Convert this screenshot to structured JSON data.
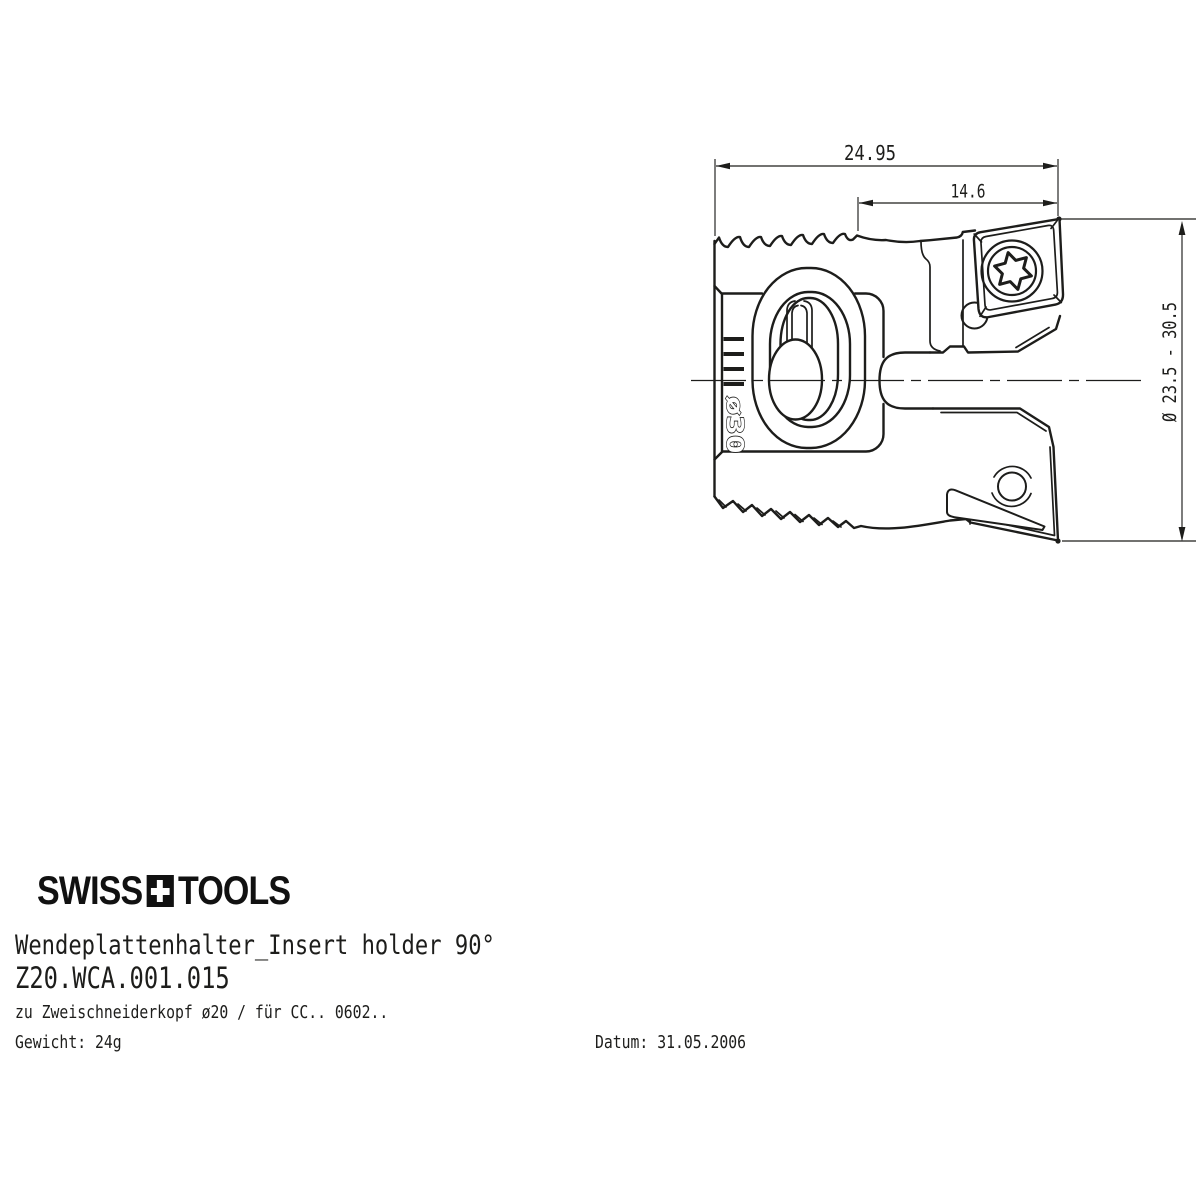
{
  "colors": {
    "line": "#1d1d1b",
    "background": "#ffffff"
  },
  "drawing": {
    "dim_overall_width": "24.95",
    "dim_insert_offset": "14.6",
    "dim_diameter_range": "Ø 23.5 - 30.5",
    "engraving": "ø30"
  },
  "footer": {
    "logo_left": "SWISS",
    "logo_right": "TOOLS",
    "title": "Wendeplattenhalter_Insert holder 90°",
    "part_number": "Z20.WCA.001.015",
    "description": "zu Zweischneiderkopf ø20 / für CC.. 0602..",
    "weight": "Gewicht: 24g",
    "date": "Datum: 31.05.2006"
  }
}
